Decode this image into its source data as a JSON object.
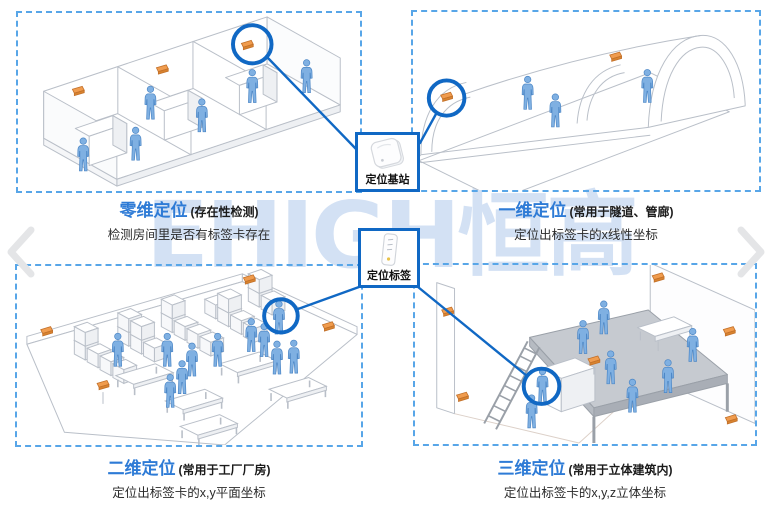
{
  "watermark": "EHIGH恒高",
  "colors": {
    "accent_blue": "#1068c4",
    "title_blue": "#2e7bd6",
    "dashed_blue": "#58a6e8",
    "anchor_orange": "#ee9a4c",
    "person_blue": "#7fb0e2",
    "watermark_blue": "#d3e1f4"
  },
  "nav": {
    "prev_icon": "chevron-left",
    "next_icon": "chevron-right"
  },
  "center": {
    "base_station_label": "定位基站",
    "tag_label": "定位标签"
  },
  "quadrants": [
    {
      "id": "zero-dim",
      "title": "零维定位",
      "qualifier": "(存在性检测)",
      "description": "检测房间里是否有标签卡存在"
    },
    {
      "id": "one-dim",
      "title": "一维定位",
      "qualifier": "(常用于隧道、管廊)",
      "description": "定位出标签卡的x线性坐标"
    },
    {
      "id": "two-dim",
      "title": "二维定位",
      "qualifier": "(常用于工厂厂房)",
      "description": "定位出标签卡的x,y平面坐标"
    },
    {
      "id": "three-dim",
      "title": "三维定位",
      "qualifier": "(常用于立体建筑内)",
      "description": "定位出标签卡的x,y,z立体坐标"
    }
  ]
}
